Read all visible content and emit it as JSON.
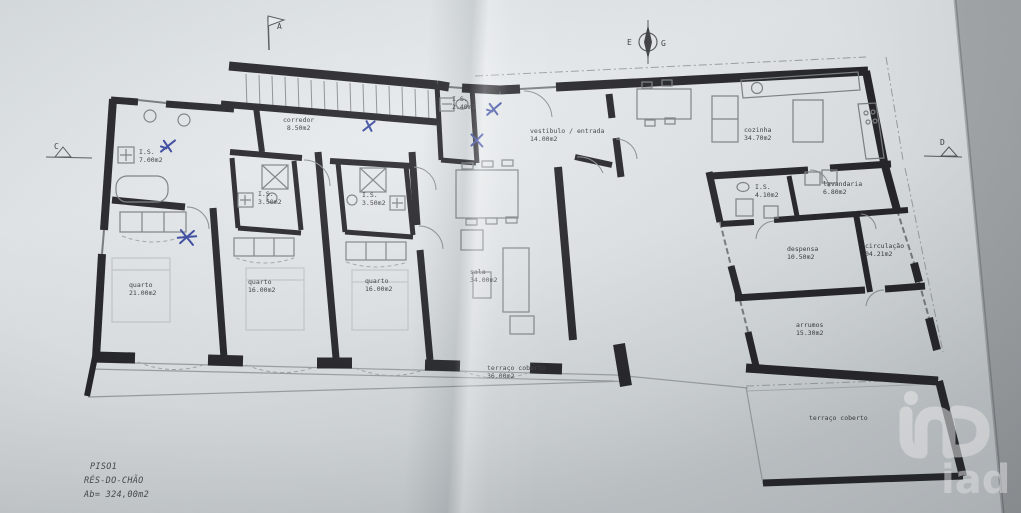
{
  "palette": {
    "paper": "#e2e6e8",
    "backdrop": "#b2b6b8",
    "wall": "#26262a",
    "thin_line": "#8a8f93",
    "pen_mark": "#3a49a0",
    "watermark": "#ffffff"
  },
  "markers": {
    "a": "A",
    "c": "C",
    "d": "D",
    "e": "E",
    "g": "G"
  },
  "rooms": {
    "corredor": {
      "name": "corredor",
      "area": "8.50m2"
    },
    "is_24": {
      "name": "I.S.",
      "area": "2.40m2"
    },
    "vestibulo": {
      "name": "vestibulo / entrada",
      "area": "14.00m2"
    },
    "cozinha": {
      "name": "cozinha",
      "area": "34.70m2"
    },
    "is_70": {
      "name": "I.S.",
      "area": "7.00m2"
    },
    "is_35a": {
      "name": "I.S.",
      "area": "3.50m2"
    },
    "is_35b": {
      "name": "I.S.",
      "area": "3.50m2"
    },
    "is_41": {
      "name": "I.S.",
      "area": "4.10m2"
    },
    "lavandaria": {
      "name": "lavandaria",
      "area": "6.80m2"
    },
    "despensa": {
      "name": "despensa",
      "area": "10.50m2"
    },
    "circulacao": {
      "name": "circulação",
      "area": "04.21m2"
    },
    "arrumos": {
      "name": "arrumos",
      "area": "15.30m2"
    },
    "quarto_1": {
      "name": "quarto",
      "area": "21.00m2"
    },
    "quarto_2": {
      "name": "quarto",
      "area": "16.00m2"
    },
    "quarto_3": {
      "name": "quarto",
      "area": "16.00m2"
    },
    "sala": {
      "name": "sala",
      "area": "34.00m2"
    },
    "terraco_1": {
      "name": "terraço coberto",
      "area": "36.00m2"
    },
    "terraco_2": {
      "name": "terraço coberto",
      "area": ""
    }
  },
  "title_block": {
    "floor_code": "PISO1",
    "floor_name": "RÉS-DO-CHÃO",
    "area_label": "Ab= 324,00m2"
  },
  "watermark": {
    "text": "iad"
  }
}
